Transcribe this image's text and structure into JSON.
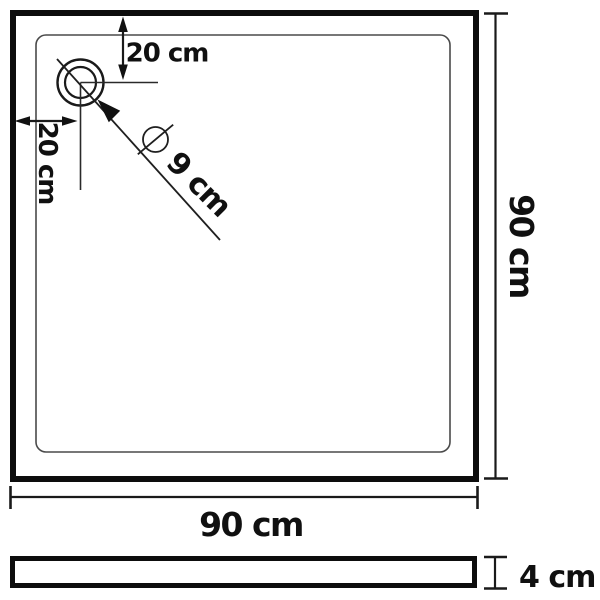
{
  "diagram": {
    "background_color": "#ffffff",
    "line_color": "#111111",
    "top_view": {
      "drain_top_offset": "20 cm",
      "drain_left_offset": "20 cm",
      "diameter_symbol": "⌀",
      "drain_diameter": "9 cm",
      "width": "90 cm",
      "height": "90 cm"
    },
    "side_view": {
      "thickness": "4 cm"
    }
  }
}
